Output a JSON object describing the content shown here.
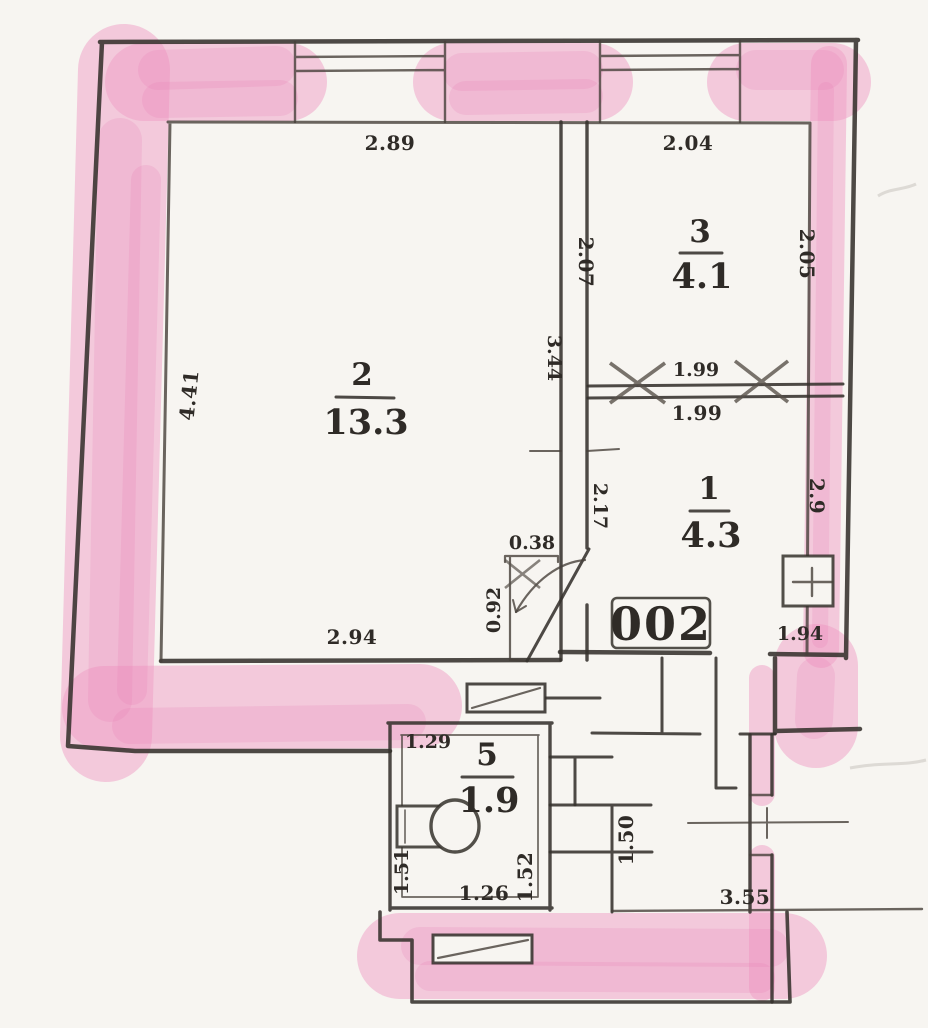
{
  "plan": {
    "apartment_label": "002",
    "rooms": [
      {
        "number": "2",
        "area": "13.3"
      },
      {
        "number": "3",
        "area": "4.1"
      },
      {
        "number": "1",
        "area": "4.3"
      },
      {
        "number": "5",
        "area": "1.9"
      }
    ],
    "dimensions": {
      "room2_top": "2.89",
      "room2_left": "4.41",
      "room2_bottom": "2.94",
      "room3_top": "2.04",
      "room3_left": "2.07",
      "room3_right": "2.05",
      "partition_upper": "1.99",
      "partition_lower": "1.99",
      "partition_left": "3.44",
      "hall_wall": "2.17",
      "door_width": "0.38",
      "door_depth": "0.92",
      "room1_right": "2.9",
      "room1_bottom": "1.94",
      "room5_top": "1.29",
      "room5_left": "1.51",
      "room5_bottom": "1.26",
      "room5_right": "1.52",
      "lower_room_left": "1.50",
      "lower_room_bottom": "3.55"
    },
    "colors": {
      "paper": "#f7f5f1",
      "ink": "#35312c",
      "highlight": "#f09dc6"
    }
  }
}
